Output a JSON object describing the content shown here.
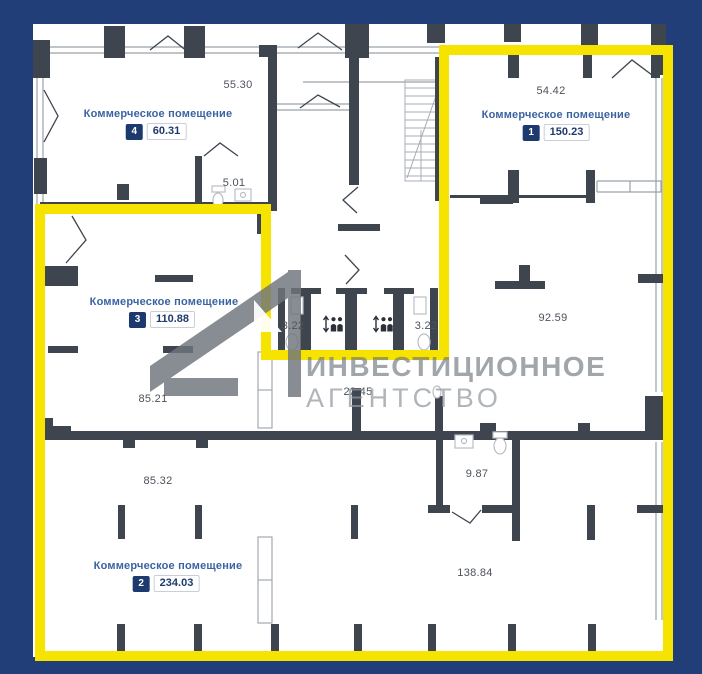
{
  "plan": {
    "rooms": [
      {
        "num": "4",
        "label": "Коммерческое помещение",
        "area": "60.31"
      },
      {
        "num": "1",
        "label": "Коммерческое помещение",
        "area": "150.23"
      },
      {
        "num": "3",
        "label": "Коммерческое помещение",
        "area": "110.88"
      },
      {
        "num": "2",
        "label": "Коммерческое помещение",
        "area": "234.03"
      }
    ],
    "areas": {
      "top_middle": "55.30",
      "wc_top": "5.01",
      "room1_top": "54.42",
      "shaft_left": "3.22",
      "shaft_right": "3.22",
      "room1_mid": "92.59",
      "mid_left": "85.21",
      "corridor": "22.45",
      "lower_left": "85.32",
      "wc_bottom": "9.87",
      "bottom_right": "138.84"
    }
  },
  "watermark": {
    "line1": "ИНВЕСТИЦИОННОЕ",
    "line2": "АГЕНТСТВО"
  },
  "icons": {
    "elevator": "elevator-people-icon",
    "stairs": "stairs-icon",
    "toilet": "toilet-icon",
    "sink": "sink-icon"
  },
  "colors": {
    "background": "#223e78",
    "highlight": "#f7e300",
    "wall": "#3f454f",
    "badge_navy": "#1d3a6e",
    "label_blue": "#3b63a2"
  }
}
